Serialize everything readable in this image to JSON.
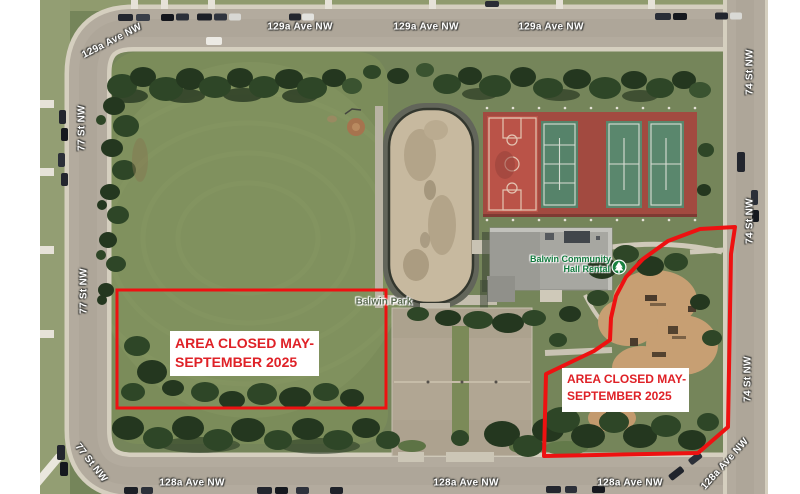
{
  "streets": {
    "top": "129a Ave NW",
    "left": "77 St NW",
    "right": "74 St NW",
    "bottom": "128a Ave NW"
  },
  "poi": {
    "hall_line1": "Balwin Community",
    "hall_line2": "Hall Rental",
    "park": "Balwin Park"
  },
  "closure": {
    "line1": "AREA CLOSED MAY-",
    "line2": "SEPTEMBER 2025"
  },
  "colors": {
    "annotation_red": "#ee1111",
    "closure_text": "#df2127",
    "hall_label": "#117a3e",
    "park_label": "#5a6a50",
    "marker_green": "#19813f"
  }
}
